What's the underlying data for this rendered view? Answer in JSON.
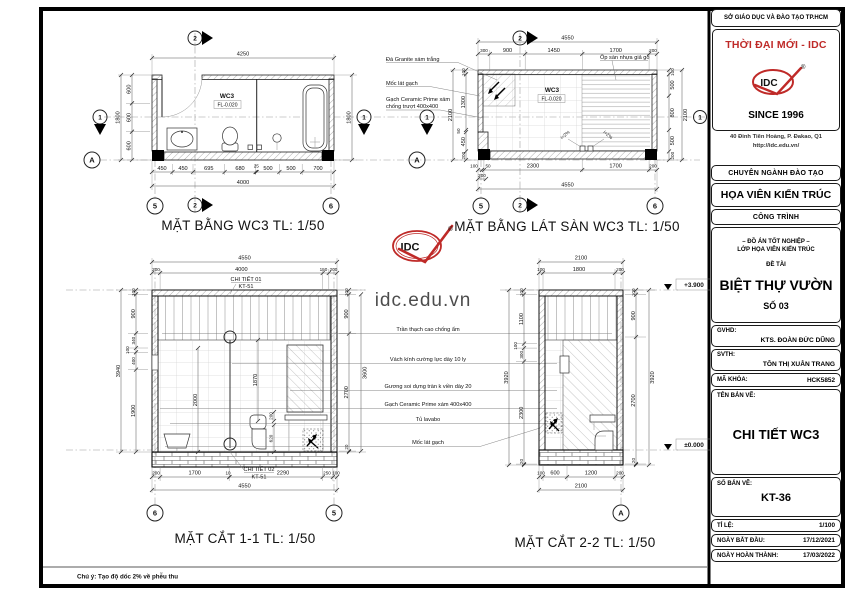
{
  "sheet": {
    "watermark": "idc.edu.vn",
    "footer_note": "Chú ý: Tạo độ dốc 2% về phễu thu",
    "accent_red": "#bf2a28"
  },
  "title_block": {
    "header": "SỞ GIÁO DỤC VÀ ĐÀO TẠO TP.HCM",
    "brand": "THỜI ĐẠI MỚI - IDC",
    "logo_text": "IDC",
    "logo_reg": "®",
    "since": "SINCE 1996",
    "address": "40 Đinh Tiên Hoàng, P. Đakao, Q1",
    "website": "http://idc.edu.vn/",
    "dept_header": "CHUYÊN NGÀNH ĐÀO TẠO",
    "dept": "HỌA VIÊN KIẾN TRÚC",
    "project_header": "CÔNG TRÌNH",
    "project_line1": "– ĐỒ ÁN TỐT NGHIỆP –",
    "project_line2": "LỚP HỌA VIÊN KIẾN TRÚC",
    "topic_label": "ĐỀ TÀI",
    "topic": "BIỆT THỰ VƯỜN",
    "topic_no": "SỐ 03",
    "gvhd_label": "GVHD:",
    "gvhd": "KTS. ĐOÀN ĐỨC DŨNG",
    "svth_label": "SVTH:",
    "svth": "TÔN THỊ XUÂN TRANG",
    "code_label": "MÃ KHÓA:",
    "code": "HCK5852",
    "drawing_name_label": "TÊN BẢN VẼ:",
    "drawing_name": "CHI TIẾT WC3",
    "sheet_no_label": "SỐ BẢN VẼ:",
    "sheet_no": "KT-36",
    "scale_label": "TỈ LỆ:",
    "scale": "1/100",
    "start_label": "NGÀY BẮT ĐẦU:",
    "start_date": "17/12/2021",
    "finish_label": "NGÀY HOÀN THÀNH:",
    "finish_date": "17/03/2022"
  },
  "plan": {
    "title": "MẶT BẰNG WC3 TL: 1/50",
    "room": "WC3",
    "level": "FL-0.020",
    "top_total": "4250",
    "left_segs": [
      "600",
      "600",
      "600"
    ],
    "left_total": "1800",
    "right_total": "1800",
    "bottom_segs": [
      "450",
      "450",
      "695",
      "680",
      "25",
      "500",
      "500",
      "700"
    ],
    "bottom_total": "4000"
  },
  "tiling": {
    "title": "MẶT BẰNG LÁT SÀN WC3 TL: 1/50",
    "room": "WC3",
    "level": "FL-0.020",
    "top_total": "4550",
    "top_segs": [
      "300",
      "900",
      "1450",
      "1700",
      "200"
    ],
    "left_segs": [
      "100",
      "1300",
      "50",
      "450",
      "200"
    ],
    "left_total": "2100",
    "right_segs": [
      "100",
      "500",
      "800",
      "500",
      "200"
    ],
    "right_total": "2100",
    "bottom_segs": [
      "100",
      "50",
      "2300",
      "1700",
      "200"
    ],
    "bottom_sub": "200",
    "bottom_total": "4550",
    "note_granite": "Đá Granite xám trắng",
    "note_moc": "Mốc lát gạch",
    "note_ceramic1": "Gạch Ceramic Prime xám",
    "note_ceramic2": "chống trượt 400x400",
    "note_wood": "Ốp sàn nhựa giả gỗ",
    "slope": "i=2%"
  },
  "section11": {
    "title": "MẶT CẮT 1-1 TL: 1/50",
    "top_total": "4550",
    "top_segs": [
      "200",
      "4000",
      "150",
      "200"
    ],
    "callout_top1": "CHI TIẾT 01",
    "callout_top2": "KT-51",
    "callout_bot1": "CHI TIẾT 02",
    "callout_bot2": "KT-51",
    "left_segs": [
      "100",
      "900",
      "340",
      "100",
      "400",
      "1900"
    ],
    "left_total": "3940",
    "right_segs": [
      "100",
      "900",
      "2700",
      "20"
    ],
    "right_mid": "3600",
    "inner_segs": [
      "2000",
      "1870",
      "200",
      "620"
    ],
    "bottom_segs": [
      "200",
      "1700",
      "10",
      "2290",
      "250",
      "100"
    ],
    "bottom_total": "4550"
  },
  "section22": {
    "title": "MẶT CẮT 2-2 TL: 1/50",
    "top_total": "2100",
    "top_segs": [
      "100",
      "1800",
      "200"
    ],
    "left_segs": [
      "100",
      "1100",
      "100",
      "300",
      "2300",
      "20"
    ],
    "left_total": "3920",
    "right_segs": [
      "100",
      "900",
      "2700",
      "20"
    ],
    "right_total": "3920",
    "bottom_segs": [
      "100",
      "600",
      "1200",
      "200"
    ],
    "bottom_total": "2100",
    "elev_top": "+3.900",
    "elev_bottom": "±0.000"
  },
  "mid_notes": [
    "Trần thạch cao chống ẩm",
    "Vách kính cường lực dày 10 ly",
    "Gương soi dựng tràn k viền dày 20",
    "Gạch Ceramic Prime xám 400x400",
    "Tủ lavabo",
    "Mốc lát gạch"
  ],
  "grid": {
    "g1": "1",
    "g2": "2",
    "g5": "5",
    "g6": "6",
    "ga": "A"
  }
}
